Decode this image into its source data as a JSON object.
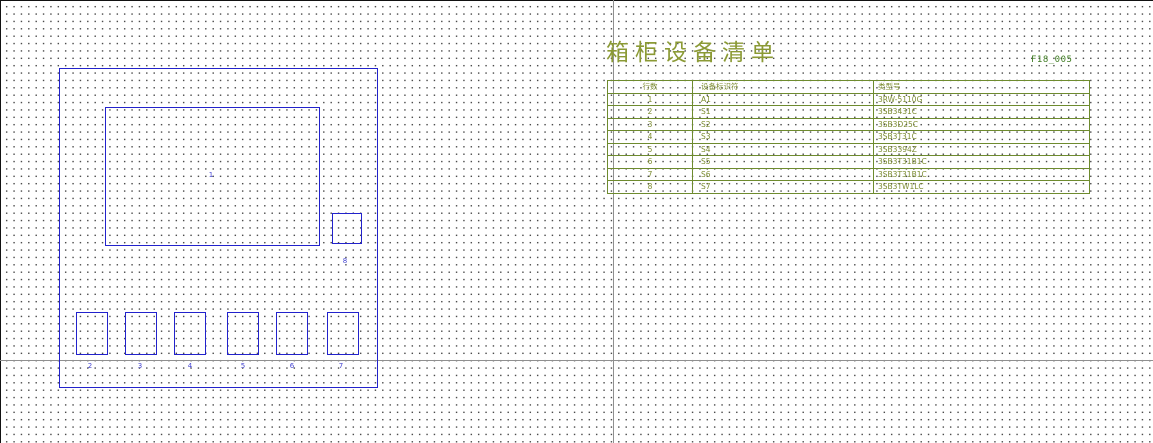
{
  "page": {
    "title": "箱柜设备清单",
    "doc_number": "F18_005"
  },
  "colors": {
    "drawing_blue": "#2222cc",
    "report_olive": "#6e8b2e",
    "title_olive": "#8b9a35",
    "doc_number_green": "#3f7d23",
    "frame_gray": "#8f8f8f"
  },
  "drawing": {
    "labels": [
      "1",
      "2",
      "3",
      "4",
      "5",
      "6",
      "7",
      "8"
    ]
  },
  "equipment_table": {
    "columns": [
      "行数",
      "设备标识符",
      "类型号"
    ],
    "rows": [
      {
        "row": "1",
        "tag": "A1",
        "part": "3RW-5110G"
      },
      {
        "row": "2",
        "tag": "S1",
        "part": "3SB3431C"
      },
      {
        "row": "3",
        "tag": "S2",
        "part": "3SB3D25C"
      },
      {
        "row": "4",
        "tag": "S3",
        "part": "3SB3T31C"
      },
      {
        "row": "5",
        "tag": "S4",
        "part": "3SB3394Z"
      },
      {
        "row": "6",
        "tag": "S5",
        "part": "3SB3T31B1C"
      },
      {
        "row": "7",
        "tag": "S6",
        "part": "3SB3T31B1C"
      },
      {
        "row": "8",
        "tag": "S7",
        "part": "3SB3TW1LC"
      }
    ]
  }
}
